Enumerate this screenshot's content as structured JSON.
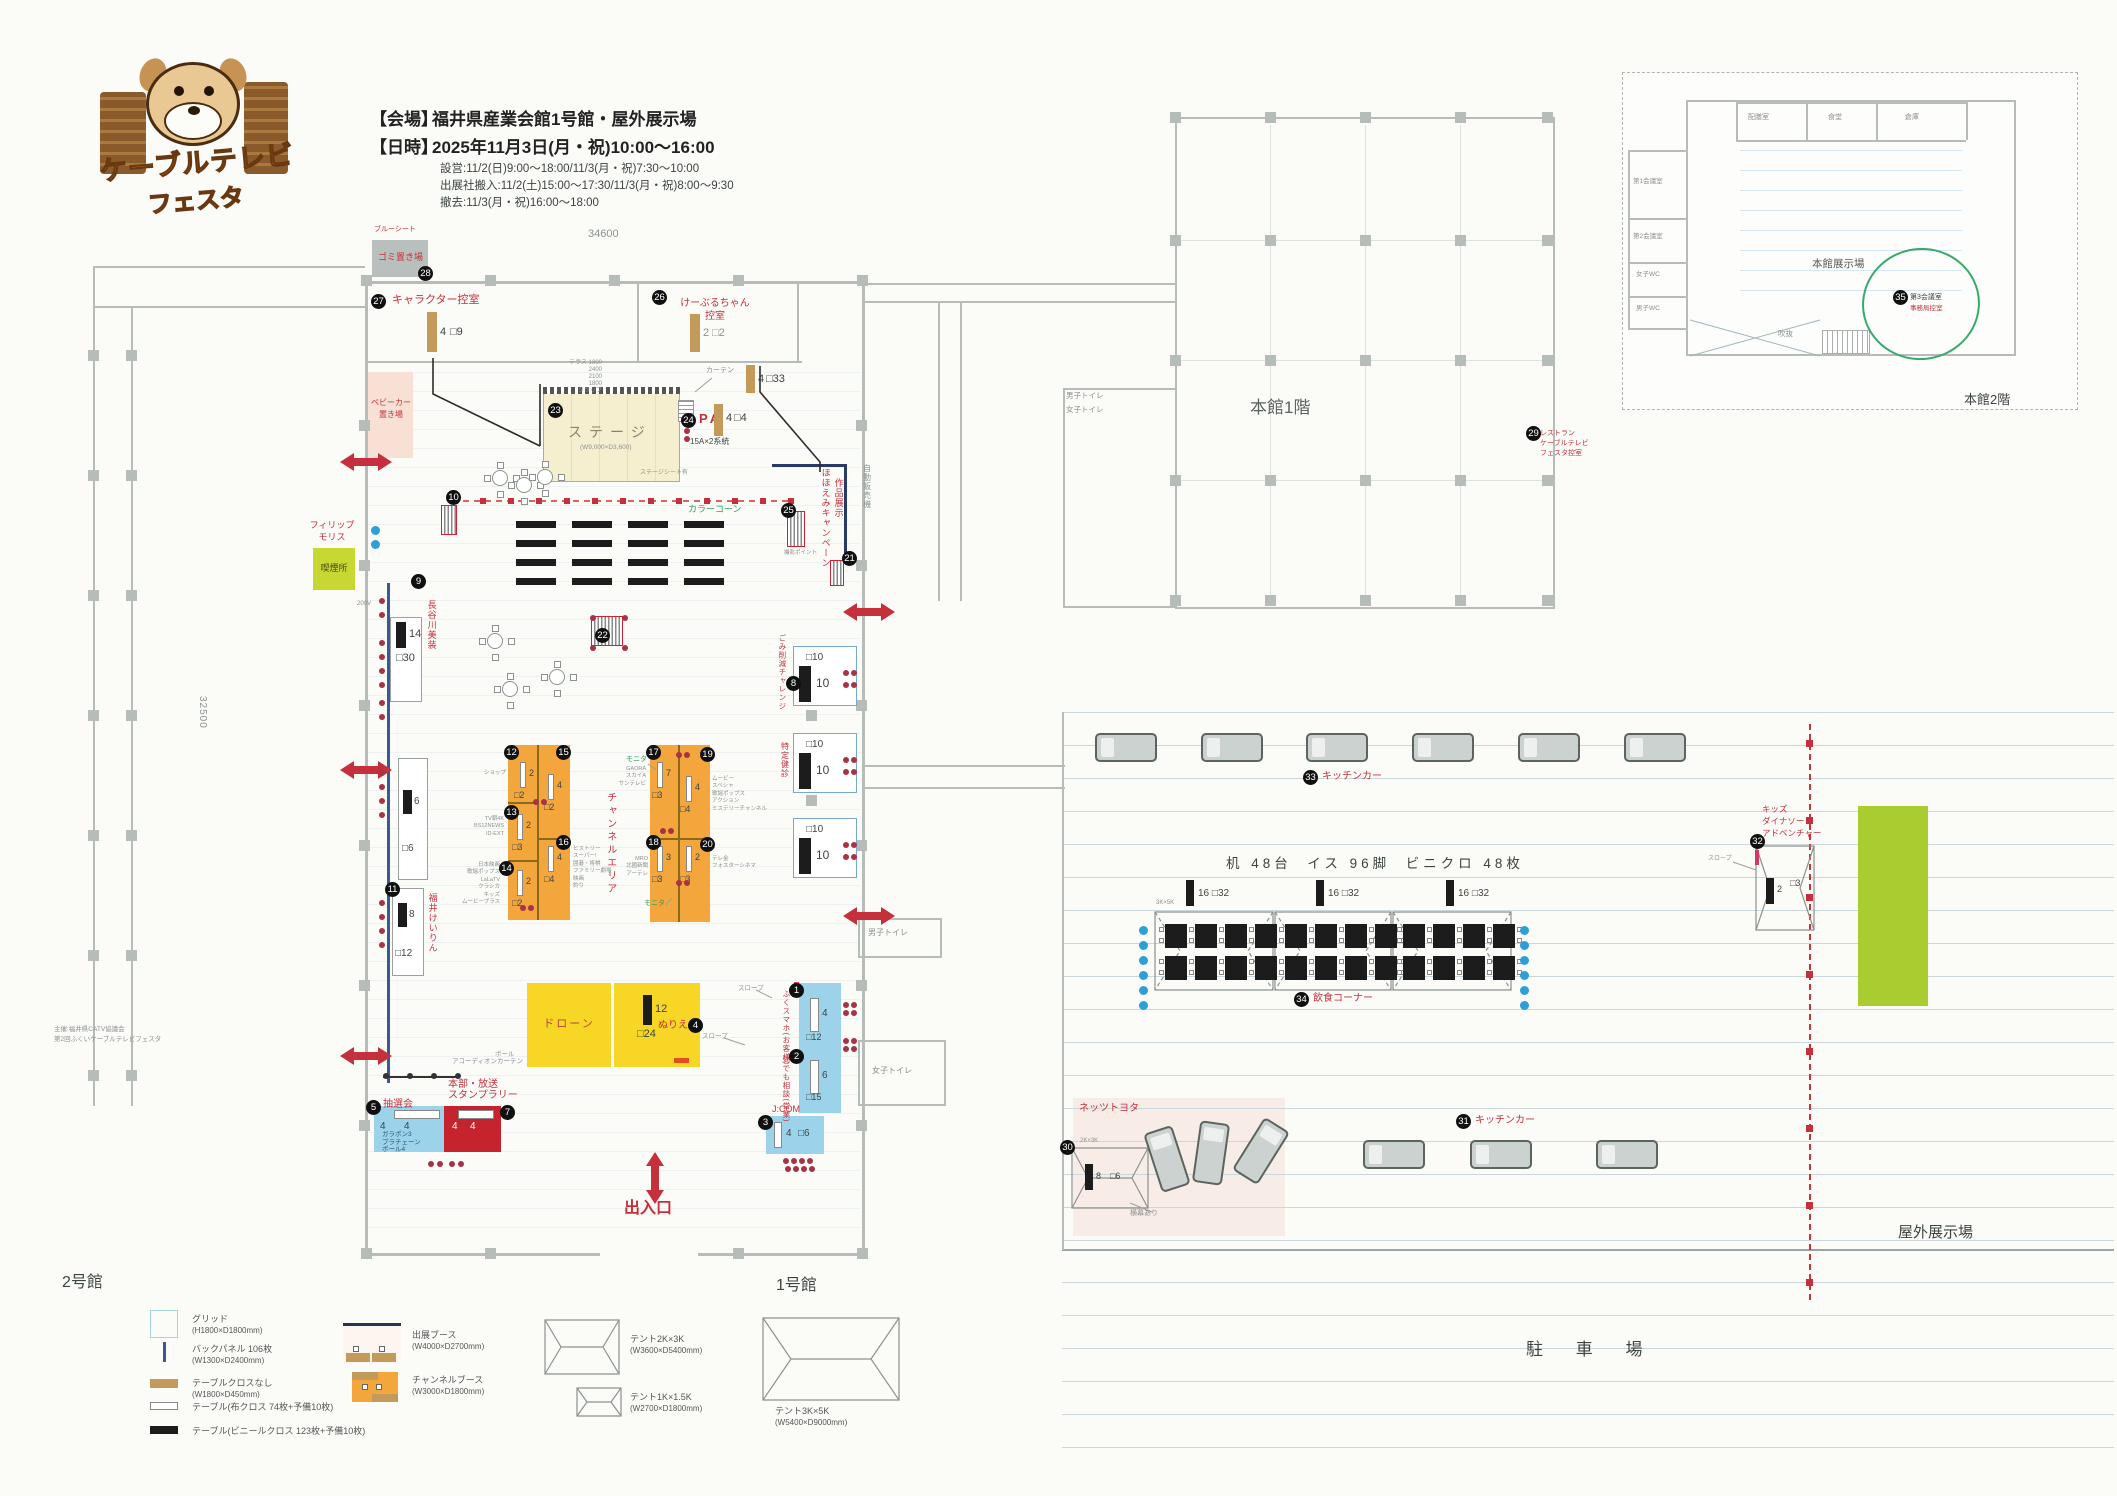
{
  "logo": {
    "line1": "ケーブルテレビ",
    "line2": "フェスタ"
  },
  "header": {
    "venue_label": "【会場】",
    "venue": "福井県産業会館1号館・屋外展示場",
    "datetime_label": "【日時】",
    "datetime": "2025年11月3日(月・祝)10:00〜16:00",
    "setup": "設営:11/2(日)9:00〜18:00/11/3(月・祝)7:30〜10:00",
    "move_in": "出展社搬入:11/2(土)15:00〜17:30/11/3(月・祝)8:00〜9:30",
    "teardown": "撤去:11/3(月・祝)16:00〜18:00"
  },
  "dims": {
    "top": "34600",
    "left": "32500"
  },
  "labels": {
    "hall1": "1号館",
    "hall2": "2号館",
    "main1f": "本館1階",
    "main2f": "本館2階",
    "outdoor": "屋外展示場",
    "parking": "駐 車 場",
    "exit": "出入口",
    "wc_women": "女子トイレ",
    "wc_men": "男子トイレ",
    "wc_men2": "男子トイレ",
    "wc_women2": "女子トイレ",
    "v_machine": "自動販売機",
    "organizer1": "主催:福井県CATV協議会",
    "organizer2": "第2回ふくいケーブルテレビフェスタ"
  },
  "top_rooms": {
    "trash": {
      "no": "28",
      "label": "ゴミ置き場",
      "note": "ブルーシート"
    },
    "chara": {
      "no": "27",
      "label": "キャラクター控室",
      "bar": "4",
      "sq": "□9"
    },
    "kbl": {
      "no": "26",
      "label1": "けーぶるちゃん",
      "label2": "控室",
      "bar": "2",
      "sq": "□2"
    },
    "stroller": {
      "label1": "ベビーカー",
      "label2": "置き場"
    }
  },
  "stage": {
    "no": "23",
    "label": "ステージ",
    "size": "(W9,000×D3,600)",
    "sheet": "ステージシート有",
    "curtain": "カーテン",
    "terrace": "テラス 1800\n2400\n2100\n1800\nタラップ",
    "pa_no": "24",
    "pa": "PA",
    "power": "15A×2系統",
    "bar1": "4",
    "sq1": "□4",
    "bar2": "4",
    "sq2": "□33"
  },
  "mid": {
    "cone": "カラーコーン",
    "cone_no": "10",
    "smile_no": "25",
    "smile1": "ほほえみキャンペーン",
    "smile2": "作品展示",
    "photo": "撮影ポイント",
    "b21": "21",
    "b22": "22",
    "b9": "9",
    "volt": "200V",
    "philip1": "フィリップ",
    "philip2": "モリス",
    "smoke": "喫煙所"
  },
  "left_booths": {
    "hasegawa": {
      "label": "長谷川美装",
      "bar": "14",
      "sq": "□30"
    },
    "mid": {
      "bar": "6",
      "sq": "□6"
    },
    "keirin": {
      "no": "11",
      "label": "福井けいりん",
      "bar": "8",
      "sq": "□12"
    }
  },
  "channel": {
    "title": "チャンネルエリア",
    "monitor1": "モニタ",
    "monitor2": "モニタ",
    "booths": [
      {
        "no": "12",
        "bar": "2",
        "sq": "□2",
        "side": "ショップ"
      },
      {
        "no": "15",
        "bar": "4",
        "sq": "□2",
        "side": ""
      },
      {
        "no": "13",
        "bar": "2",
        "sq": "□3",
        "side": "TV朝4K\nBS12NEWS\nID-EXT"
      },
      {
        "no": "16",
        "bar": "4",
        "sq": "□4",
        "side": "ヒストリー\nスーパー!\n囲碁・将棋\nファミリー劇場\n映画\n釣り"
      },
      {
        "no": "14",
        "bar": "2",
        "sq": "□2",
        "side": "日本映画\n歌謡ポップス\nLaLaTV\nクラシカ\nキッズ\nムービープラス"
      },
      {
        "no": "17",
        "bar": "7",
        "sq": "□3",
        "side": "GAORA\nスカイA\nサンテレビ"
      },
      {
        "no": "19",
        "bar": "4",
        "sq": "□4",
        "side": "ムービー\nスペシャ\n歌謡ポップス\nアクション\nミステリーチャンネル"
      },
      {
        "no": "18",
        "bar": "3",
        "sq": "□3",
        "side": "MRO\n北國新聞\nアーテレ"
      },
      {
        "no": "20",
        "bar": "2",
        "sq": "□3",
        "side": "テレ金\nフォスターシネマ"
      }
    ]
  },
  "right_booths": [
    {
      "no": "8",
      "label": "ごみ削減チャレンジ",
      "sq": "□10",
      "bar": "10"
    },
    {
      "no": "",
      "label": "特定健診",
      "sq": "□10",
      "bar": "10"
    },
    {
      "no": "",
      "label": "",
      "sq": "□10",
      "bar": "10"
    }
  ],
  "bottom": {
    "accordion": "アコーディオンカーテン",
    "drone": "ドローン",
    "nurie": {
      "no": "4",
      "label": "ぬりえ",
      "bar": "12",
      "sq": "□24"
    },
    "pole": "ポール",
    "slope1": "スロープ",
    "slope2": "スロープ",
    "lottery": {
      "no": "5",
      "label": "抽選会",
      "n1": "4",
      "n2": "4",
      "items": "ガラポン3\nプラチェーン\nポール4"
    },
    "hq": {
      "no": "7",
      "label1": "本部・放送",
      "label2": "スタンプラリー",
      "n1": "4",
      "n2": "4"
    },
    "fukusma": {
      "no": "1",
      "label": "ふくスマホ(お客様)",
      "bar1": "4",
      "sq1": "□12"
    },
    "soudan": {
      "no": "2",
      "label": "何でも相談(営業)",
      "bar2": "6",
      "sq2": "□15"
    },
    "jcom": {
      "no": "3",
      "label": "J:COM",
      "bar": "4",
      "sq": "□6"
    }
  },
  "main1f": {
    "rest_no": "29",
    "rest1": "レストラン",
    "rest2": "ケーブルテレビ",
    "rest3": "フェスタ控室"
  },
  "main2f": {
    "hall": "本館展示場",
    "r_top1": "配膳室",
    "r_top2": "食堂",
    "r_top3": "倉庫",
    "r_l1": "第1会議室",
    "r_l2": "第2会議室",
    "r_l3": "女子WC",
    "r_l4": "男子WC",
    "m3_no": "35",
    "m3": "第3会議室",
    "m3sub": "事務局控室",
    "atrium": "吹抜"
  },
  "outdoor": {
    "kt_no": "33",
    "kt": "キッチンカー",
    "kb_no": "31",
    "kb": "キッチンカー",
    "dining_no": "34",
    "dining": "飲食コーナー",
    "title": "机 48台  イス 96脚  ビニクロ 48枚",
    "grp": "16 □32",
    "tent": "3K×5K",
    "dino_no": "32",
    "dino1": "キッズ",
    "dino2": "ダイナソー",
    "dino3": "アドベンチャー",
    "dino_bar": "2",
    "dino_sq": "□3",
    "dino_slope": "スロープ",
    "netz_no": "30",
    "netz": "ネッツトヨタ",
    "netz_tent": "2K×3K",
    "netz_bar": "8",
    "netz_sq": "□6",
    "netz_note": "横幕あり"
  },
  "legend": [
    {
      "label": "グリッド",
      "size": "(H1800×D1800mm)"
    },
    {
      "label": "バックパネル 106枚",
      "size": "(W1300×D2400mm)"
    },
    {
      "label": "テーブルクロスなし",
      "size": "(W1800×D450mm)"
    },
    {
      "label": "テーブル(布クロス 74枚+予備10枚)",
      "size": ""
    },
    {
      "label": "テーブル(ビニールクロス 123枚+予備10枚)",
      "size": ""
    },
    {
      "label": "出展ブース",
      "size": "(W4000×D2700mm)"
    },
    {
      "label": "チャンネルブース",
      "size": "(W3000×D1800mm)"
    },
    {
      "label": "テント2K×3K",
      "size": "(W3600×D5400mm)"
    },
    {
      "label": "テント1K×1.5K",
      "size": "(W2700×D1800mm)"
    },
    {
      "label": "テント3K×5K",
      "size": "(W5400×D9000mm)"
    }
  ],
  "colors": {
    "accent_red": "#c5303c",
    "booth_orange": "#f2a63c",
    "stage_cream": "#f5efcf",
    "highlight_yellow": "#f7d626",
    "box_blue": "#9cd3eb",
    "box_red": "#c5242f",
    "green_area": "#a9cc30",
    "smoke_green": "#c8d832",
    "pink": "#f8e0d4"
  }
}
